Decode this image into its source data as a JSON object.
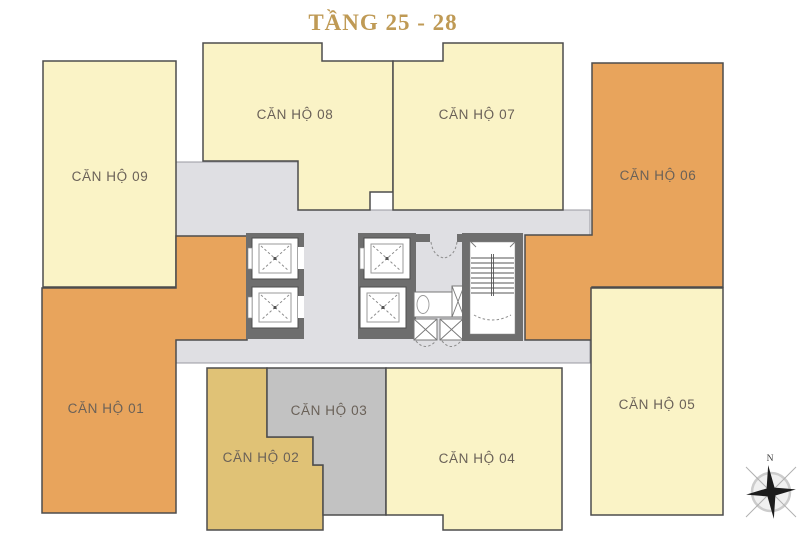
{
  "title": "TẦNG 25 - 28",
  "compass": {
    "north_label": "N"
  },
  "colors": {
    "background": "#FFFFFF",
    "pale_yellow": "#FAF3C6",
    "orange": "#E8A45C",
    "gold": "#E0C276",
    "gray_unit": "#C2C2C2",
    "corridor": "#DFDFE3",
    "wall": "#6E6E6E",
    "outline": "#4D4D4D",
    "title": "#BF9A55",
    "label_text": "#6A6158"
  },
  "floor_plan": {
    "apartments": [
      {
        "id": "can-ho-01",
        "label": "CĂN HỘ 01",
        "color": "#E8A45C"
      },
      {
        "id": "can-ho-02",
        "label": "CĂN HỘ 02",
        "color": "#E0C276"
      },
      {
        "id": "can-ho-03",
        "label": "CĂN HỘ 03",
        "color": "#C2C2C2"
      },
      {
        "id": "can-ho-04",
        "label": "CĂN HỘ 04",
        "color": "#FAF3C6"
      },
      {
        "id": "can-ho-05",
        "label": "CĂN HỘ 05",
        "color": "#FAF3C6"
      },
      {
        "id": "can-ho-06",
        "label": "CĂN HỘ 06",
        "color": "#E8A45C"
      },
      {
        "id": "can-ho-07",
        "label": "CĂN HỘ 07",
        "color": "#FAF3C6"
      },
      {
        "id": "can-ho-08",
        "label": "CĂN HỘ 08",
        "color": "#FAF3C6"
      },
      {
        "id": "can-ho-09",
        "label": "CĂN HỘ 09",
        "color": "#FAF3C6"
      }
    ]
  }
}
